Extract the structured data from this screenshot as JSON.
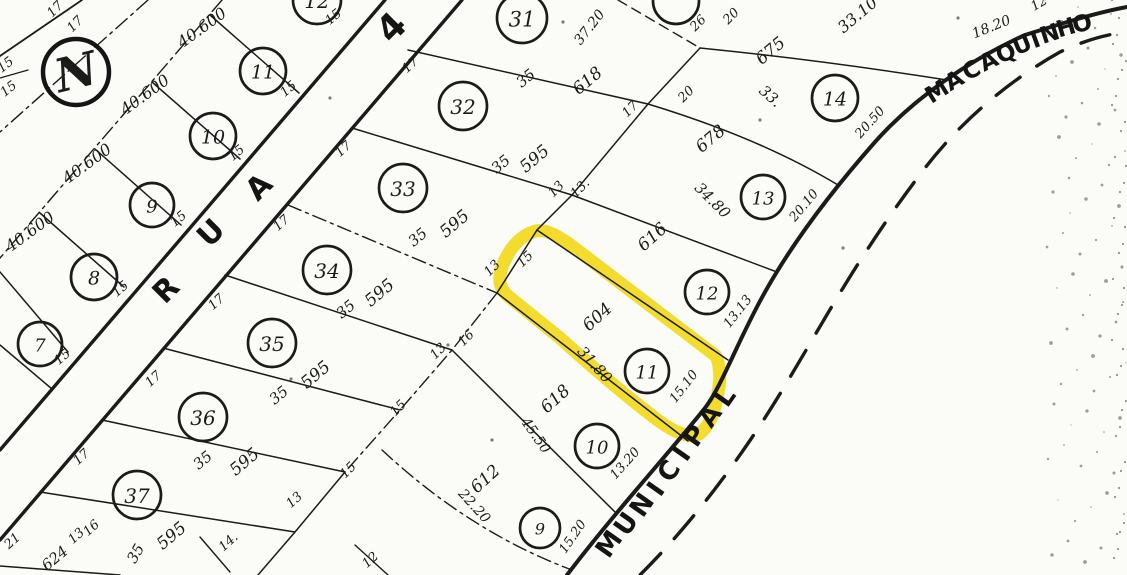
{
  "colors": {
    "ink": "#1b1b1b",
    "paper": "#fbfbf7",
    "highlight": "#F0D400"
  },
  "north": {
    "label": "N"
  },
  "streets": {
    "rua4": {
      "name": "RUA 4"
    },
    "municipal": {
      "name": "MUNICIPAL"
    },
    "macaquinho": {
      "name": "MACAQUINHO"
    }
  },
  "highlight": {
    "lot_number": "11",
    "lot_area": "604",
    "color": "#F0D400"
  },
  "lot_circles": [
    {
      "n": "12",
      "x": 317,
      "y": 0,
      "rad": 24,
      "g": "left-block"
    },
    {
      "n": "11",
      "x": 263,
      "y": 71,
      "rad": 23,
      "g": "left-block"
    },
    {
      "n": "10",
      "x": 213,
      "y": 136,
      "rad": 23,
      "g": "left-block"
    },
    {
      "n": "9",
      "x": 152,
      "y": 205,
      "rad": 22,
      "g": "left-block"
    },
    {
      "n": "8",
      "x": 94,
      "y": 277,
      "rad": 23,
      "g": "left-block"
    },
    {
      "n": "7",
      "x": 40,
      "y": 344,
      "rad": 22,
      "g": "left-block"
    },
    {
      "n": "31",
      "x": 522,
      "y": 18,
      "rad": 25,
      "g": "rua4-block"
    },
    {
      "n": "32",
      "x": 463,
      "y": 106,
      "rad": 24,
      "g": "rua4-block"
    },
    {
      "n": "33",
      "x": 403,
      "y": 188,
      "rad": 24,
      "g": "rua4-block"
    },
    {
      "n": "34",
      "x": 327,
      "y": 270,
      "rad": 24,
      "g": "rua4-block"
    },
    {
      "n": "35",
      "x": 272,
      "y": 343,
      "rad": 24,
      "g": "rua4-block"
    },
    {
      "n": "36",
      "x": 203,
      "y": 417,
      "rad": 24,
      "g": "rua4-block"
    },
    {
      "n": "37",
      "x": 137,
      "y": 495,
      "rad": 24,
      "g": "rua4-block"
    },
    {
      "n": "",
      "x": 676,
      "y": 1,
      "rad": 23,
      "g": "road-block"
    },
    {
      "n": "14",
      "x": 835,
      "y": 98,
      "rad": 23,
      "g": "road-block"
    },
    {
      "n": "13",
      "x": 763,
      "y": 197,
      "rad": 22,
      "g": "road-block"
    },
    {
      "n": "12",
      "x": 707,
      "y": 292,
      "rad": 22,
      "g": "road-block"
    },
    {
      "n": "11",
      "x": 647,
      "y": 371,
      "rad": 22,
      "g": "road-block"
    },
    {
      "n": "10",
      "x": 597,
      "y": 446,
      "rad": 22,
      "g": "road-block"
    },
    {
      "n": "9",
      "x": 540,
      "y": 528,
      "rad": 20,
      "g": "road-block"
    }
  ],
  "labels": [
    {
      "t": "17",
      "x": 58,
      "y": 12,
      "r": -45,
      "s": 13,
      "n": "lot-width-label"
    },
    {
      "t": "17",
      "x": 78,
      "y": 27,
      "r": -45,
      "s": 13,
      "n": "lot-width-label"
    },
    {
      "t": "15",
      "x": 8,
      "y": 68,
      "r": -38,
      "s": 13,
      "n": "lot-width-label"
    },
    {
      "t": "15",
      "x": 11,
      "y": 92,
      "r": -38,
      "s": 13,
      "n": "lot-width-label"
    },
    {
      "t": "40.600",
      "x": 205,
      "y": 32,
      "r": -36,
      "s": 16,
      "n": "lot-area-label"
    },
    {
      "t": "40.600",
      "x": 148,
      "y": 99,
      "r": -36,
      "s": 16,
      "n": "lot-area-label"
    },
    {
      "t": "40.600",
      "x": 90,
      "y": 168,
      "r": -36,
      "s": 16,
      "n": "lot-area-label"
    },
    {
      "t": "40.600",
      "x": 33,
      "y": 236,
      "r": -36,
      "s": 16,
      "n": "lot-area-label"
    },
    {
      "t": "15",
      "x": 336,
      "y": 20,
      "r": -40,
      "s": 13,
      "n": "lot-width-label"
    },
    {
      "t": "15",
      "x": 291,
      "y": 92,
      "r": -40,
      "s": 13,
      "n": "lot-width-label"
    },
    {
      "t": "15",
      "x": 239,
      "y": 156,
      "r": -40,
      "s": 13,
      "n": "lot-width-label"
    },
    {
      "t": "15",
      "x": 181,
      "y": 222,
      "r": -40,
      "s": 13,
      "n": "lot-width-label"
    },
    {
      "t": "15",
      "x": 123,
      "y": 292,
      "r": -40,
      "s": 13,
      "n": "lot-width-label"
    },
    {
      "t": "15",
      "x": 65,
      "y": 360,
      "r": -40,
      "s": 13,
      "n": "lot-width-label"
    },
    {
      "t": "17",
      "x": 413,
      "y": 68,
      "r": -42,
      "s": 13,
      "n": "lot-width-label"
    },
    {
      "t": "17",
      "x": 346,
      "y": 152,
      "r": -42,
      "s": 13,
      "n": "lot-width-label"
    },
    {
      "t": "17",
      "x": 284,
      "y": 226,
      "r": -42,
      "s": 13,
      "n": "lot-width-label"
    },
    {
      "t": "17",
      "x": 219,
      "y": 305,
      "r": -42,
      "s": 13,
      "n": "lot-width-label"
    },
    {
      "t": "17",
      "x": 156,
      "y": 382,
      "r": -42,
      "s": 13,
      "n": "lot-width-label"
    },
    {
      "t": "17",
      "x": 84,
      "y": 460,
      "r": -42,
      "s": 13,
      "n": "lot-width-label"
    },
    {
      "t": "16",
      "x": 94,
      "y": 531,
      "r": -42,
      "s": 13,
      "n": "lot-width-label"
    },
    {
      "t": "21",
      "x": 15,
      "y": 544,
      "r": -42,
      "s": 13,
      "n": "lot-width-label"
    },
    {
      "t": "13",
      "x": 79,
      "y": 539,
      "r": -42,
      "s": 13,
      "n": "lot-width-label"
    },
    {
      "t": "14.",
      "x": 231,
      "y": 545,
      "r": -42,
      "s": 13,
      "n": "lot-width-label"
    },
    {
      "t": "12",
      "x": 373,
      "y": 563,
      "r": -42,
      "s": 13,
      "n": "lot-width-label"
    },
    {
      "t": "13",
      "x": 297,
      "y": 503,
      "r": -42,
      "s": 13,
      "n": "lot-width-label"
    },
    {
      "t": "35",
      "x": 529,
      "y": 82,
      "r": -40,
      "s": 15,
      "n": "lot-depth-label"
    },
    {
      "t": "618",
      "x": 591,
      "y": 85,
      "r": -40,
      "s": 17,
      "n": "lot-area-label"
    },
    {
      "t": "35",
      "x": 504,
      "y": 168,
      "r": -40,
      "s": 15,
      "n": "lot-depth-label"
    },
    {
      "t": "595",
      "x": 538,
      "y": 163,
      "r": -40,
      "s": 17,
      "n": "lot-area-label"
    },
    {
      "t": "35",
      "x": 421,
      "y": 241,
      "r": -40,
      "s": 15,
      "n": "lot-depth-label"
    },
    {
      "t": "595",
      "x": 458,
      "y": 228,
      "r": -40,
      "s": 17,
      "n": "lot-area-label"
    },
    {
      "t": "35",
      "x": 349,
      "y": 313,
      "r": -40,
      "s": 15,
      "n": "lot-depth-label"
    },
    {
      "t": "595",
      "x": 383,
      "y": 297,
      "r": -40,
      "s": 17,
      "n": "lot-area-label"
    },
    {
      "t": "35",
      "x": 282,
      "y": 399,
      "r": -40,
      "s": 15,
      "n": "lot-depth-label"
    },
    {
      "t": "595",
      "x": 319,
      "y": 379,
      "r": -40,
      "s": 17,
      "n": "lot-area-label"
    },
    {
      "t": "35",
      "x": 206,
      "y": 464,
      "r": -40,
      "s": 15,
      "n": "lot-depth-label"
    },
    {
      "t": "595",
      "x": 248,
      "y": 466,
      "r": -40,
      "s": 17,
      "n": "lot-area-label"
    },
    {
      "t": "35",
      "x": 140,
      "y": 556,
      "r": -60,
      "s": 15,
      "n": "lot-depth-label"
    },
    {
      "t": "595",
      "x": 175,
      "y": 540,
      "r": -40,
      "s": 17,
      "n": "lot-area-label"
    },
    {
      "t": "675",
      "x": 774,
      "y": 55,
      "r": -40,
      "s": 17,
      "n": "lot-area-label"
    },
    {
      "t": "33.",
      "x": 767,
      "y": 100,
      "r": 42,
      "s": 15,
      "n": "boundary-length-label"
    },
    {
      "t": "678",
      "x": 714,
      "y": 143,
      "r": -40,
      "s": 17,
      "n": "lot-area-label"
    },
    {
      "t": "34.80",
      "x": 709,
      "y": 204,
      "r": 45,
      "s": 15,
      "n": "boundary-length-label"
    },
    {
      "t": "616",
      "x": 656,
      "y": 241,
      "r": -42,
      "s": 17,
      "n": "lot-area-label"
    },
    {
      "t": "604",
      "x": 601,
      "y": 321,
      "r": -42,
      "s": 17,
      "n": "lot-area-label"
    },
    {
      "t": "31.80",
      "x": 591,
      "y": 368,
      "r": 48,
      "s": 15,
      "n": "boundary-length-label"
    },
    {
      "t": "618",
      "x": 559,
      "y": 403,
      "r": -42,
      "s": 17,
      "n": "lot-area-label"
    },
    {
      "t": "45.50",
      "x": 532,
      "y": 438,
      "r": 55,
      "s": 14,
      "n": "boundary-length-label"
    },
    {
      "t": "612",
      "x": 489,
      "y": 483,
      "r": -42,
      "s": 17,
      "n": "lot-area-label"
    },
    {
      "t": "22.20",
      "x": 471,
      "y": 509,
      "r": 48,
      "s": 14,
      "n": "boundary-length-label"
    },
    {
      "t": "33.10",
      "x": 861,
      "y": 19,
      "r": -40,
      "s": 16,
      "n": "boundary-length-label"
    },
    {
      "t": "18.20",
      "x": 993,
      "y": 31,
      "r": -22,
      "s": 14,
      "n": "boundary-length-label"
    },
    {
      "t": "12",
      "x": 1041,
      "y": 7,
      "r": -30,
      "s": 13,
      "n": "lot-width-label"
    },
    {
      "t": "20.50",
      "x": 873,
      "y": 125,
      "r": -48,
      "s": 13,
      "n": "frontage-label"
    },
    {
      "t": "20.10",
      "x": 807,
      "y": 208,
      "r": -50,
      "s": 13,
      "n": "frontage-label"
    },
    {
      "t": "13.13",
      "x": 741,
      "y": 314,
      "r": -52,
      "s": 13,
      "n": "frontage-label"
    },
    {
      "t": "15.10",
      "x": 687,
      "y": 389,
      "r": -52,
      "s": 13,
      "n": "frontage-label"
    },
    {
      "t": "13.20",
      "x": 628,
      "y": 466,
      "r": -48,
      "s": 13,
      "n": "frontage-label"
    },
    {
      "t": "15.20",
      "x": 576,
      "y": 539,
      "r": -55,
      "s": 13,
      "n": "frontage-label"
    },
    {
      "t": "26",
      "x": 701,
      "y": 26,
      "r": -45,
      "s": 13,
      "n": "lot-width-label"
    },
    {
      "t": "20",
      "x": 734,
      "y": 19,
      "r": -45,
      "s": 13,
      "n": "lot-width-label"
    },
    {
      "t": "20",
      "x": 689,
      "y": 97,
      "r": -45,
      "s": 13,
      "n": "lot-width-label"
    },
    {
      "t": "17",
      "x": 633,
      "y": 112,
      "r": -45,
      "s": 13,
      "n": "lot-width-label"
    },
    {
      "t": "13",
      "x": 559,
      "y": 192,
      "r": -45,
      "s": 13,
      "n": "lot-width-label"
    },
    {
      "t": "13.",
      "x": 583,
      "y": 191,
      "r": -45,
      "s": 13,
      "n": "lot-width-label"
    },
    {
      "t": "13",
      "x": 495,
      "y": 271,
      "r": -45,
      "s": 13,
      "n": "lot-width-label"
    },
    {
      "t": "15",
      "x": 528,
      "y": 262,
      "r": -45,
      "s": 13,
      "n": "lot-width-label"
    },
    {
      "t": "16",
      "x": 469,
      "y": 341,
      "r": -45,
      "s": 13,
      "n": "lot-width-label"
    },
    {
      "t": "13",
      "x": 441,
      "y": 354,
      "r": -45,
      "s": 13,
      "n": "lot-width-label"
    },
    {
      "t": "15",
      "x": 401,
      "y": 411,
      "r": -45,
      "s": 13,
      "n": "lot-width-label"
    },
    {
      "t": "15",
      "x": 351,
      "y": 473,
      "r": -45,
      "s": 13,
      "n": "lot-width-label"
    },
    {
      "t": "37.20",
      "x": 593,
      "y": 30,
      "r": -52,
      "s": 14,
      "n": "boundary-length-label"
    },
    {
      "t": "624",
      "x": 58,
      "y": 562,
      "r": -40,
      "s": 15,
      "n": "lot-area-label"
    }
  ]
}
